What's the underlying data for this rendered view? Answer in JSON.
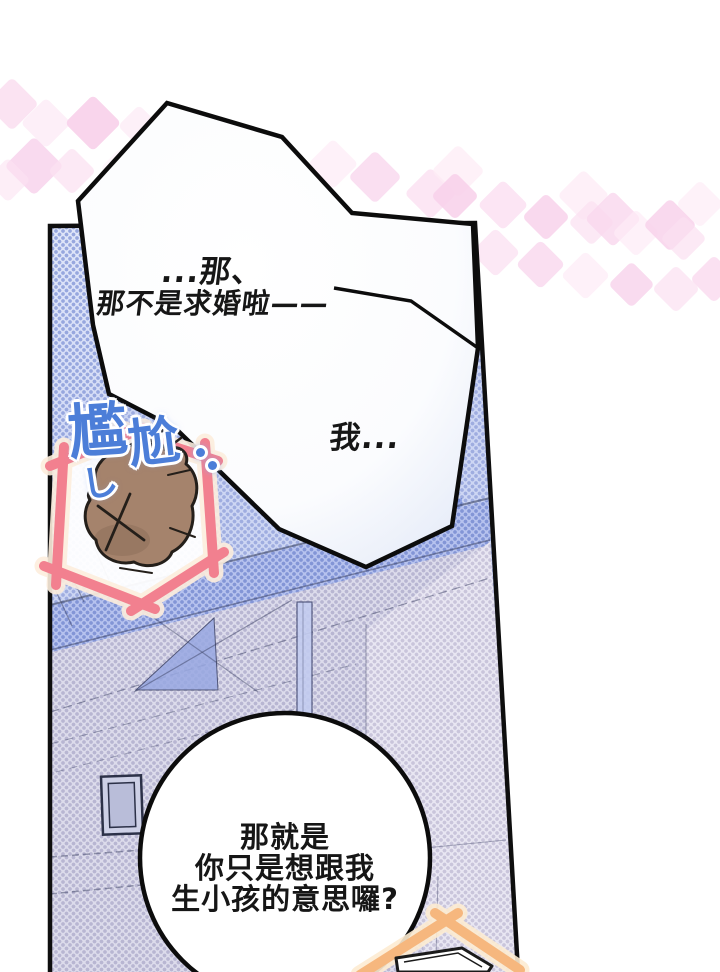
{
  "comic": {
    "bubble_top": {
      "line1": "...那、",
      "line2": "那不是求婚啦——",
      "line3": "我..."
    },
    "bubble_bottom": {
      "lines": [
        "那就是",
        "你只是想跟我",
        "生小孩的意思囉?"
      ]
    },
    "sfx": {
      "char1": "尷",
      "char2": "尬",
      "swoosh": "し"
    }
  },
  "colors": {
    "page_bg": "#ffffff",
    "panel_halftone_base": "#cdd6f3",
    "panel_halftone_dot": "#9fade0",
    "wall_halftone": "#dcdbeb",
    "dark_pillar": "#92a5e4",
    "sfx_blue": "#4c7ed8",
    "pink_frame": "#f2808f",
    "pink_frame_glow": "#fdeedd",
    "orange_frame": "#f6b77e",
    "orange_frame_glow": "#fdecd2",
    "rock_brown": "#a5836c",
    "outline_black": "#0e0e0e",
    "diamond_pink": "#f8d0ea"
  },
  "decor": {
    "diamonds": [
      {
        "x": 12,
        "y": 104,
        "s": 38,
        "c": "#f9d9ee",
        "o": 0.75
      },
      {
        "x": 46,
        "y": 123,
        "s": 36,
        "c": "#fdebf6",
        "o": 0.8
      },
      {
        "x": 93,
        "y": 123,
        "s": 40,
        "c": "#f8d0ea",
        "o": 0.9
      },
      {
        "x": 139,
        "y": 126,
        "s": 30,
        "c": "#fceaf5",
        "o": 0.7
      },
      {
        "x": 34,
        "y": 166,
        "s": 42,
        "c": "#f8d3ec",
        "o": 0.85
      },
      {
        "x": 72,
        "y": 171,
        "s": 34,
        "c": "#fbe2f2",
        "o": 0.75
      },
      {
        "x": 8,
        "y": 180,
        "s": 32,
        "c": "#fbe2f2",
        "o": 0.6
      },
      {
        "x": 120,
        "y": 168,
        "s": 28,
        "c": "#fdeef8",
        "o": 0.55
      },
      {
        "x": 333,
        "y": 164,
        "s": 36,
        "c": "#fdebf6",
        "o": 0.7
      },
      {
        "x": 375,
        "y": 177,
        "s": 38,
        "c": "#f9d7ee",
        "o": 0.8
      },
      {
        "x": 430,
        "y": 193,
        "s": 37,
        "c": "#fbe0f1",
        "o": 0.8
      },
      {
        "x": 458,
        "y": 171,
        "s": 38,
        "c": "#fdecf6",
        "o": 0.75
      },
      {
        "x": 455,
        "y": 196,
        "s": 34,
        "c": "#f8d0ea",
        "o": 0.85
      },
      {
        "x": 503,
        "y": 205,
        "s": 36,
        "c": "#fbdff1",
        "o": 0.8
      },
      {
        "x": 546,
        "y": 217,
        "s": 34,
        "c": "#f8d0ea",
        "o": 0.8
      },
      {
        "x": 583,
        "y": 195,
        "s": 37,
        "c": "#fdebf6",
        "o": 0.75
      },
      {
        "x": 591,
        "y": 222,
        "s": 33,
        "c": "#fbe0f1",
        "o": 0.7
      },
      {
        "x": 613,
        "y": 219,
        "s": 40,
        "c": "#f9d7ee",
        "o": 0.8
      },
      {
        "x": 636,
        "y": 233,
        "s": 34,
        "c": "#fdebf6",
        "o": 0.7
      },
      {
        "x": 670,
        "y": 225,
        "s": 38,
        "c": "#f8d2eb",
        "o": 0.85
      },
      {
        "x": 700,
        "y": 204,
        "s": 34,
        "c": "#fdecf6",
        "o": 0.7
      },
      {
        "x": 683,
        "y": 238,
        "s": 33,
        "c": "#fbe0f1",
        "o": 0.7
      },
      {
        "x": 495,
        "y": 252,
        "s": 35,
        "c": "#fbe0f1",
        "o": 0.75
      },
      {
        "x": 540,
        "y": 264,
        "s": 35,
        "c": "#f9d7ee",
        "o": 0.8
      },
      {
        "x": 585,
        "y": 275,
        "s": 35,
        "c": "#fdebf6",
        "o": 0.7
      },
      {
        "x": 631,
        "y": 284,
        "s": 33,
        "c": "#f8d2eb",
        "o": 0.8
      },
      {
        "x": 676,
        "y": 289,
        "s": 34,
        "c": "#fbe0f1",
        "o": 0.7
      },
      {
        "x": 714,
        "y": 279,
        "s": 34,
        "c": "#f9d7ee",
        "o": 0.75
      }
    ]
  }
}
